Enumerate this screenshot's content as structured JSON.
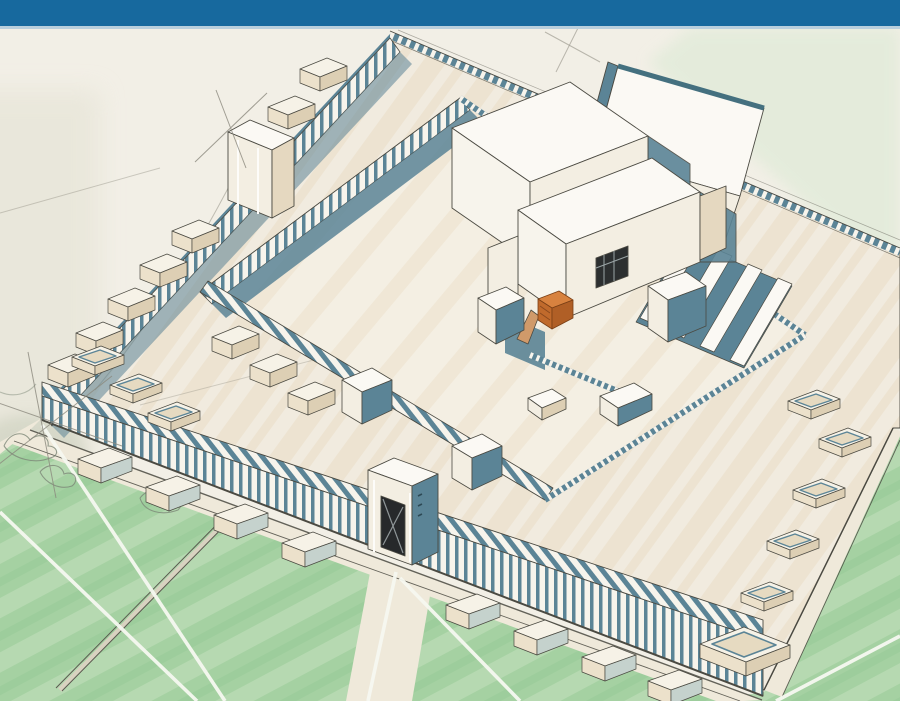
{
  "header": {
    "bar_color": "#17699e",
    "underline_color": "#b9cfdd"
  },
  "illustration": {
    "alt": "Hand-drawn aerial perspective sketch of a walled temple complex with colonnaded outer courts, gate towers, chamber rows, an inner court, a central sanctuary building with an orange altar and ramp, surrounded by green fields crossed by white paths",
    "colors": {
      "paper": "#f2efe6",
      "court_base": "#f1ebdf",
      "court_streak_a": "#eadcc3",
      "court_streak_b": "#e4d4b8",
      "inner_base": "#f4efe3",
      "wall_white": "#f7f4ec",
      "wall_teal": "#5b8496",
      "teal_deep": "#44707f",
      "ink": "#4b4a42",
      "sketch_gray": "#8b897e",
      "green_field": "#a5d1a2",
      "green_streak": "#c4e0bd",
      "green_dark": "#90c493",
      "green_wash": "#e1ebd9",
      "gray_wash": "#e7e5d8",
      "road_cream": "#efe9da",
      "path_white": "#f6f8f1",
      "roof_white": "#fbf9f4",
      "face_cream": "#f3eee2",
      "face_tan": "#e5d8c0",
      "face_dark_tan": "#ddcfb4",
      "chamber_top": "#f6f2e7",
      "chamber_front": "#ece1cb",
      "chamber_side_teal": "#c5d2cd",
      "open_floor": "#e6dac1",
      "altar_orange": "#d8823f",
      "altar_front": "#c06a2c",
      "altar_side": "#b05f26",
      "altar_ramp": "#d09a6a",
      "door_dark": "#27292b",
      "veg_ink": "#7d8878",
      "veg_fill": "#c9cebc",
      "window_dark": "#2c2f30"
    }
  }
}
